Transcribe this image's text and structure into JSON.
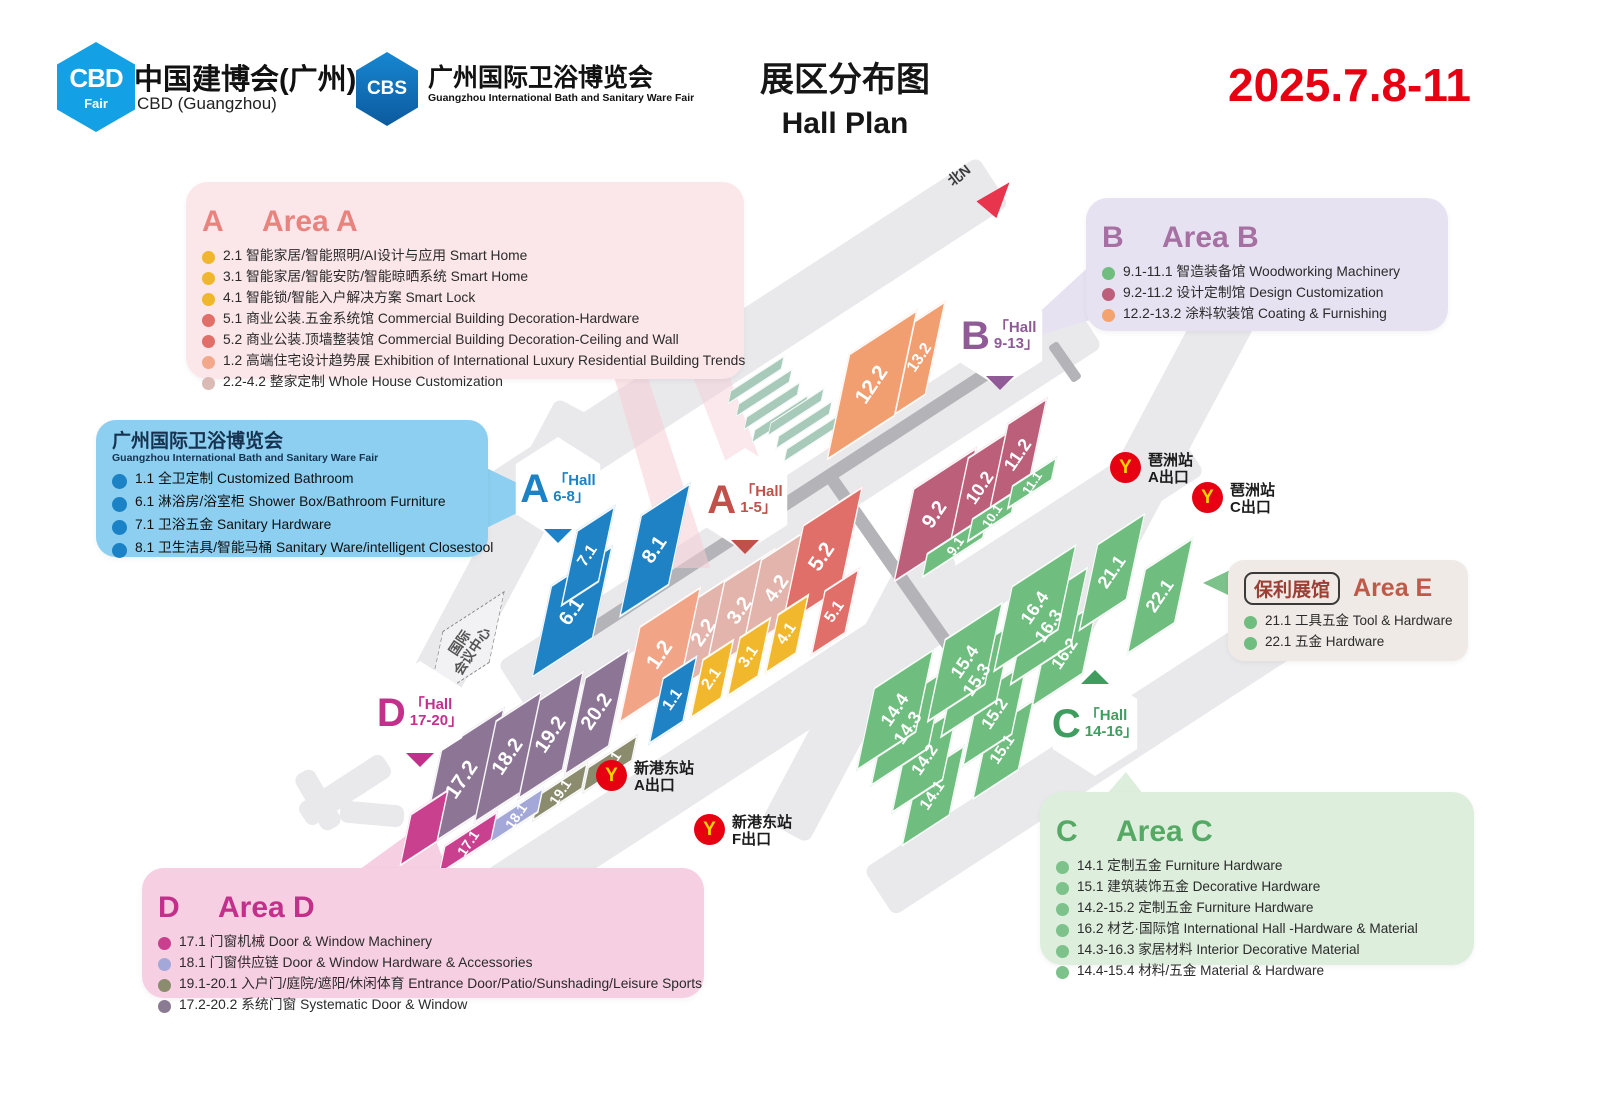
{
  "header": {
    "cbd_logo_big": "CBD",
    "cbd_logo_small": "Fair",
    "cbd_title": "中国建博会(广州)",
    "cbd_subtitle": "CBD (Guangzhou)",
    "cbs_logo_big": "CBS",
    "cbs_title": "广州国际卫浴博览会",
    "cbs_subtitle": "Guangzhou International Bath and Sanitary Ware Fair",
    "title_zh": "展区分布图",
    "title_en": "Hall Plan",
    "date": "2025.7.8-11"
  },
  "legend_a": {
    "t1": "A",
    "t2": "区",
    "t3": " Area A",
    "items": [
      {
        "dot": "#f0b62c",
        "text": "2.1 智能家居/智能照明/AI设计与应用 Smart Home"
      },
      {
        "dot": "#f0b62c",
        "text": "3.1 智能家居/智能安防/智能晾晒系统 Smart Home"
      },
      {
        "dot": "#f0b62c",
        "text": "4.1 智能锁/智能入户解决方案 Smart Lock"
      },
      {
        "dot": "#df6f68",
        "text": "5.1 商业公装.五金系统馆 Commercial Building Decoration-Hardware"
      },
      {
        "dot": "#df6f68",
        "text": "5.2 商业公装.顶墙整装馆 Commercial Building Decoration-Ceiling and Wall"
      },
      {
        "dot": "#f2a98b",
        "text": "1.2 高端住宅设计趋势展 Exhibition of International Luxury Residential Building Trends"
      },
      {
        "dot": "#d9bab4",
        "text": "2.2-4.2 整家定制 Whole House Customization"
      }
    ]
  },
  "legend_b": {
    "t1": "B",
    "t2": "区",
    "t3": " Area B",
    "items": [
      {
        "dot": "#6fbd7f",
        "text": "9.1-11.1 智造装备馆 Woodworking Machinery"
      },
      {
        "dot": "#bc5f7a",
        "text": "9.2-11.2 设计定制馆 Design Customization"
      },
      {
        "dot": "#f4a26e",
        "text": "12.2-13.2 涂料软装馆 Coating & Furnishing"
      }
    ]
  },
  "legend_bath": {
    "title_zh": "广州国际卫浴博览会",
    "title_en": "Guangzhou International Bath and Sanitary Ware Fair",
    "items": [
      {
        "dot": "#1b82c5",
        "text": "1.1 全卫定制 Customized Bathroom"
      },
      {
        "dot": "#1b82c5",
        "text": "6.1 淋浴房/浴室柜 Shower Box/Bathroom Furniture"
      },
      {
        "dot": "#1b82c5",
        "text": "7.1 卫浴五金 Sanitary Hardware"
      },
      {
        "dot": "#1b82c5",
        "text": "8.1 卫生洁具/智能马桶 Sanitary Ware/intelligent Closestool"
      }
    ]
  },
  "legend_e": {
    "badge": "保利展馆",
    "title": "Area E",
    "items": [
      {
        "dot": "#6fbd7f",
        "text": "21.1 工具五金 Tool & Hardware"
      },
      {
        "dot": "#6fbd7f",
        "text": "22.1 五金 Hardware"
      }
    ]
  },
  "legend_c": {
    "t1": "C",
    "t2": "区",
    "t3": " Area C",
    "items": [
      {
        "dot": "#7cc28a",
        "text": "14.1 定制五金 Furniture Hardware"
      },
      {
        "dot": "#7cc28a",
        "text": "15.1 建筑装饰五金 Decorative Hardware"
      },
      {
        "dot": "#7cc28a",
        "text": "14.2-15.2 定制五金 Furniture Hardware"
      },
      {
        "dot": "#7cc28a",
        "text": "16.2 材艺·国际馆 International Hall -Hardware & Material"
      },
      {
        "dot": "#7cc28a",
        "text": "14.3-16.3 家居材料 Interior Decorative Material"
      },
      {
        "dot": "#7cc28a",
        "text": "14.4-15.4 材料/五金 Material & Hardware"
      }
    ]
  },
  "legend_d": {
    "t1": "D",
    "t2": "区",
    "t3": " Area D",
    "items": [
      {
        "dot": "#c9408f",
        "text": "17.1 门窗机械  Door & Window Machinery"
      },
      {
        "dot": "#a3a8d8",
        "text": "18.1 门窗供应链  Door & Window Hardware & Accessories"
      },
      {
        "dot": "#8b8b6e",
        "text": "19.1-20.1 入户门/庭院/遮阳/休闲体育 Entrance Door/Patio/Sunshading/Leisure Sports"
      },
      {
        "dot": "#8a7a92",
        "text": "17.2-20.2 系统门窗 Systematic Door & Window"
      }
    ]
  },
  "map": {
    "north_label": "北N",
    "convention": {
      "line1": "国际",
      "line2": "会议中心",
      "x": 466,
      "y": 647
    },
    "badges": [
      {
        "letter": "A",
        "l1": "「Hall",
        "l2": "6-8」",
        "color": "#1b82c5",
        "x": 558,
        "y": 489,
        "tri": "b"
      },
      {
        "letter": "A",
        "l1": "「Hall",
        "l2": "1-5」",
        "color": "#c05049",
        "x": 745,
        "y": 500,
        "tri": "b"
      },
      {
        "letter": "B",
        "l1": "「Hall",
        "l2": "9-13」",
        "color": "#8f5a96",
        "x": 1000,
        "y": 336,
        "tri": "b"
      },
      {
        "letter": "C",
        "l1": "「Hall",
        "l2": "14-16」",
        "color": "#3f9e5f",
        "x": 1095,
        "y": 724,
        "tri": "t"
      },
      {
        "letter": "D",
        "l1": "「Hall",
        "l2": "17-20」",
        "color": "#c2308c",
        "x": 420,
        "y": 713,
        "tri": "b"
      }
    ],
    "metro": [
      {
        "station": "琶洲站",
        "exit": "A出口",
        "x": 1110,
        "y": 452
      },
      {
        "station": "琶洲站",
        "exit": "C出口",
        "x": 1192,
        "y": 482
      },
      {
        "station": "新港东站",
        "exit": "A出口",
        "x": 596,
        "y": 760
      },
      {
        "station": "新港东站",
        "exit": "F出口",
        "x": 694,
        "y": 814
      }
    ],
    "blocks": [
      {
        "label": "2.2",
        "x": 704,
        "y": 633,
        "w": 62,
        "h": 100,
        "c": "#e2b4ab",
        "fs": 20
      },
      {
        "label": "3.2",
        "x": 740,
        "y": 611,
        "w": 62,
        "h": 100,
        "c": "#e2b4ab",
        "fs": 20
      },
      {
        "label": "4.2",
        "x": 777,
        "y": 589,
        "w": 62,
        "h": 100,
        "c": "#e2b4ab",
        "fs": 20
      },
      {
        "label": "5.2",
        "x": 822,
        "y": 557,
        "w": 72,
        "h": 110,
        "c": "#df6f68",
        "fs": 21
      },
      {
        "label": "1.2",
        "x": 660,
        "y": 655,
        "w": 74,
        "h": 104,
        "c": "#f2a486",
        "fs": 21
      },
      {
        "label": "2.1",
        "x": 712,
        "y": 679,
        "w": 38,
        "h": 64,
        "c": "#f2b82d",
        "fs": 16
      },
      {
        "label": "3.1",
        "x": 749,
        "y": 657,
        "w": 38,
        "h": 64,
        "c": "#f2b82d",
        "fs": 16
      },
      {
        "label": "4.1",
        "x": 787,
        "y": 634,
        "w": 38,
        "h": 64,
        "c": "#f2b82d",
        "fs": 16
      },
      {
        "label": "5.1",
        "x": 835,
        "y": 612,
        "w": 42,
        "h": 70,
        "c": "#df6f68",
        "fs": 16
      },
      {
        "label": "1.1",
        "x": 673,
        "y": 700,
        "w": 42,
        "h": 72,
        "c": "#1e82c4",
        "fs": 16
      },
      {
        "label": "6.1",
        "x": 572,
        "y": 612,
        "w": 74,
        "h": 100,
        "c": "#1e82c4",
        "fs": 20
      },
      {
        "label": "7.1",
        "x": 588,
        "y": 556,
        "w": 46,
        "h": 82,
        "c": "#1e82c4",
        "fs": 16
      },
      {
        "label": "8.1",
        "x": 655,
        "y": 550,
        "w": 60,
        "h": 110,
        "c": "#1e82c4",
        "fs": 20
      },
      {
        "label": "12.2",
        "x": 872,
        "y": 385,
        "w": 82,
        "h": 114,
        "c": "#f19e70",
        "fs": 21
      },
      {
        "label": "13.2",
        "x": 920,
        "y": 358,
        "w": 38,
        "h": 102,
        "c": "#f19e70",
        "fs": 16
      },
      {
        "label": "9.2",
        "x": 935,
        "y": 515,
        "w": 76,
        "h": 102,
        "c": "#bc5f7a",
        "fs": 20
      },
      {
        "label": "10.2",
        "x": 980,
        "y": 488,
        "w": 52,
        "h": 96,
        "c": "#bc5f7a",
        "fs": 18
      },
      {
        "label": "11.2",
        "x": 1018,
        "y": 455,
        "w": 48,
        "h": 96,
        "c": "#bc5f7a",
        "fs": 18
      },
      {
        "label": "9.1",
        "x": 955,
        "y": 546,
        "w": 74,
        "h": 28,
        "c": "#6fbd7f",
        "fs": 14
      },
      {
        "label": "10.1",
        "x": 992,
        "y": 516,
        "w": 54,
        "h": 26,
        "c": "#6fbd7f",
        "fs": 13
      },
      {
        "label": "11.1",
        "x": 1032,
        "y": 483,
        "w": 54,
        "h": 26,
        "c": "#6fbd7f",
        "fs": 13
      },
      {
        "label": "14.1",
        "x": 933,
        "y": 796,
        "w": 58,
        "h": 76,
        "c": "#6fbd7f",
        "fs": 16
      },
      {
        "label": "14.2",
        "x": 925,
        "y": 760,
        "w": 62,
        "h": 80,
        "c": "#6fbd7f",
        "fs": 17
      },
      {
        "label": "14.3",
        "x": 908,
        "y": 728,
        "w": 70,
        "h": 86,
        "c": "#6fbd7f",
        "fs": 18
      },
      {
        "label": "14.4",
        "x": 895,
        "y": 710,
        "w": 72,
        "h": 90,
        "c": "#6fbd7f",
        "fs": 18
      },
      {
        "label": "15.1",
        "x": 1003,
        "y": 750,
        "w": 56,
        "h": 76,
        "c": "#6fbd7f",
        "fs": 16
      },
      {
        "label": "15.2",
        "x": 995,
        "y": 714,
        "w": 60,
        "h": 80,
        "c": "#6fbd7f",
        "fs": 17
      },
      {
        "label": "15.3",
        "x": 977,
        "y": 680,
        "w": 68,
        "h": 86,
        "c": "#6fbd7f",
        "fs": 18
      },
      {
        "label": "15.4",
        "x": 965,
        "y": 662,
        "w": 70,
        "h": 90,
        "c": "#6fbd7f",
        "fs": 18
      },
      {
        "label": "16.2",
        "x": 1065,
        "y": 654,
        "w": 62,
        "h": 80,
        "c": "#6fbd7f",
        "fs": 17
      },
      {
        "label": "16.3",
        "x": 1049,
        "y": 626,
        "w": 74,
        "h": 86,
        "c": "#6fbd7f",
        "fs": 18
      },
      {
        "label": "16.4",
        "x": 1035,
        "y": 608,
        "w": 78,
        "h": 92,
        "c": "#6fbd7f",
        "fs": 18
      },
      {
        "label": "21.1",
        "x": 1112,
        "y": 572,
        "w": 58,
        "h": 94,
        "c": "#6fbd7f",
        "fs": 18
      },
      {
        "label": "22.1",
        "x": 1160,
        "y": 596,
        "w": 58,
        "h": 92,
        "c": "#6fbd7f",
        "fs": 18
      },
      {
        "label": "17.2",
        "x": 462,
        "y": 780,
        "w": 76,
        "h": 112,
        "c": "#8d7596",
        "fs": 21
      },
      {
        "label": "18.2",
        "x": 508,
        "y": 757,
        "w": 56,
        "h": 110,
        "c": "#8d7596",
        "fs": 20
      },
      {
        "label": "19.2",
        "x": 551,
        "y": 735,
        "w": 54,
        "h": 108,
        "c": "#8d7596",
        "fs": 20
      },
      {
        "label": "20.2",
        "x": 597,
        "y": 712,
        "w": 54,
        "h": 106,
        "c": "#8d7596",
        "fs": 20
      },
      {
        "label": "19.1",
        "x": 560,
        "y": 792,
        "w": 60,
        "h": 30,
        "c": "#8b8b6e",
        "fs": 14
      },
      {
        "label": "20.1",
        "x": 610,
        "y": 764,
        "w": 60,
        "h": 30,
        "c": "#8b8b6e",
        "fs": 14
      },
      {
        "label": "18.1",
        "x": 516,
        "y": 816,
        "w": 60,
        "h": 28,
        "c": "#a3a8d8",
        "fs": 14
      },
      {
        "label": "",
        "x": 424,
        "y": 828,
        "w": 46,
        "h": 58,
        "c": "#c9408f",
        "fs": 0
      },
      {
        "label": "17.1",
        "x": 468,
        "y": 843,
        "w": 64,
        "h": 32,
        "c": "#c9408f",
        "fs": 14
      }
    ]
  }
}
